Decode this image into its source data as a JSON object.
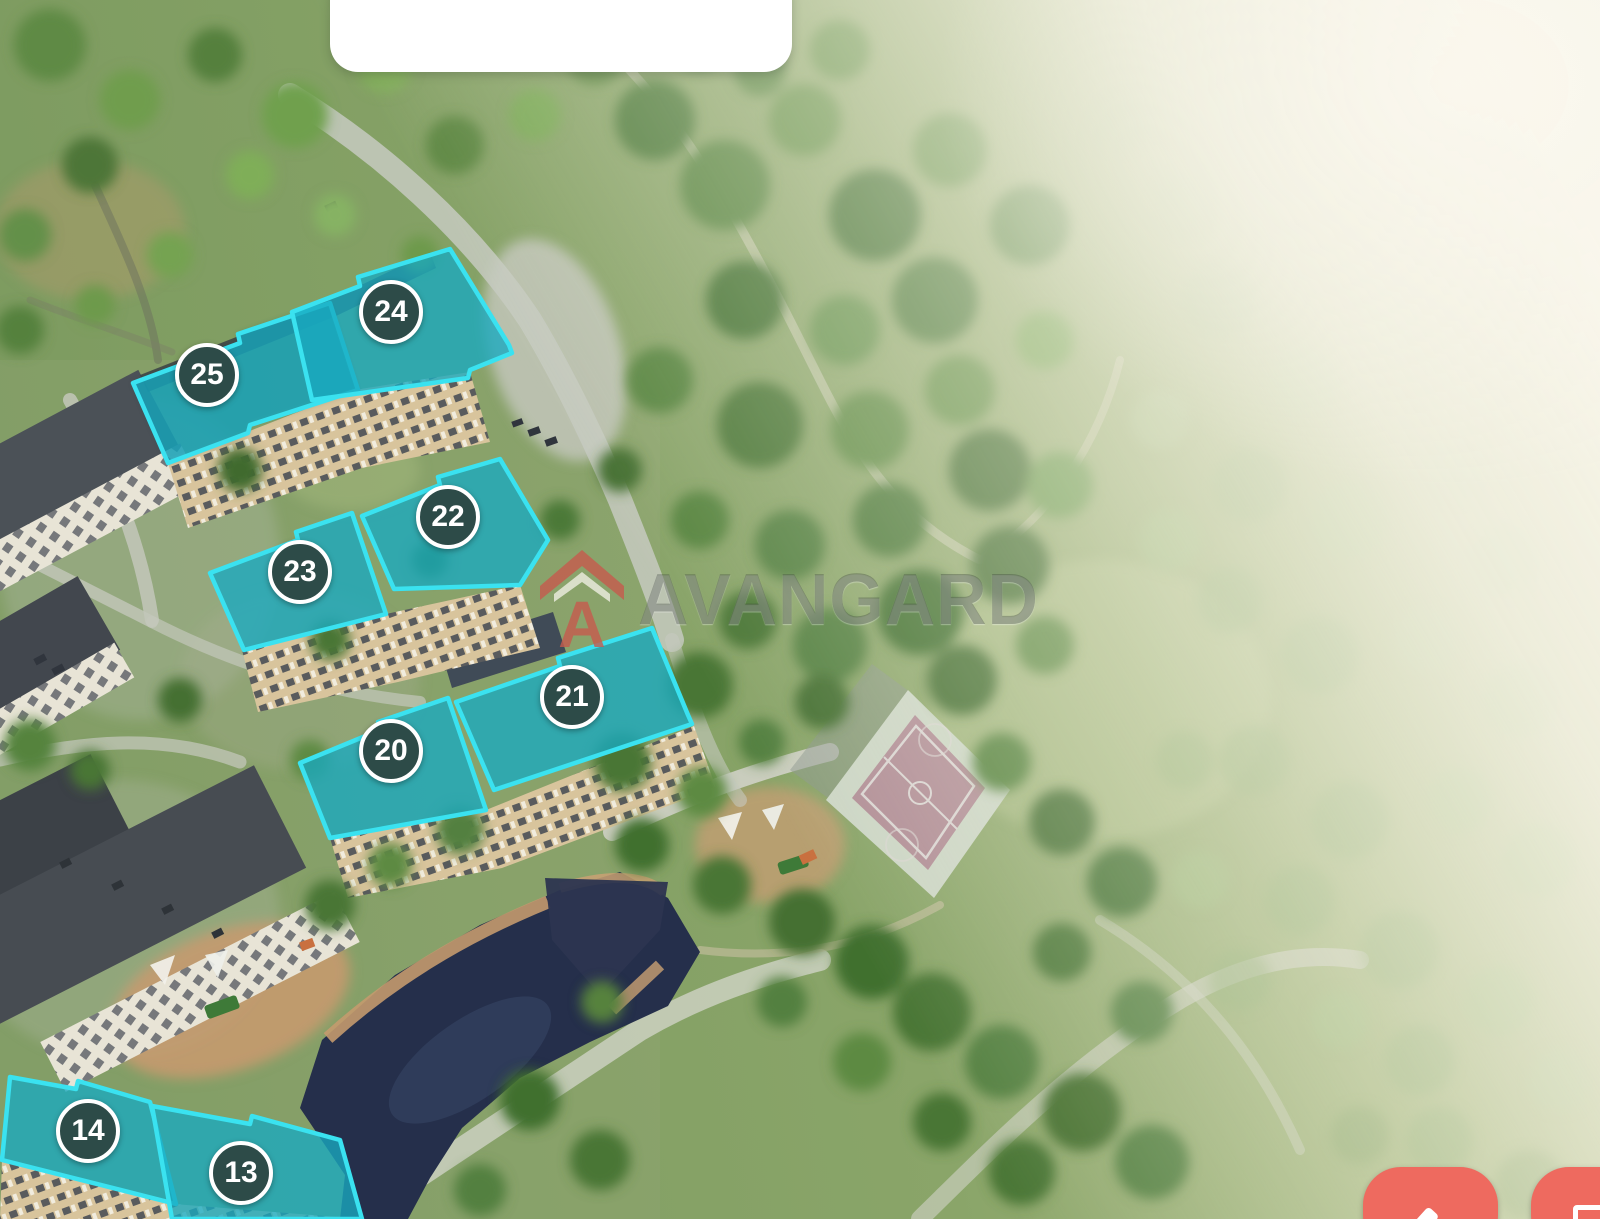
{
  "map": {
    "watermark": {
      "text": "AVANGARD",
      "logo_icon": "avangard-roof-a-logo"
    },
    "markers": [
      {
        "label": "24"
      },
      {
        "label": "25"
      },
      {
        "label": "22"
      },
      {
        "label": "23"
      },
      {
        "label": "21"
      },
      {
        "label": "20"
      },
      {
        "label": "14"
      },
      {
        "label": "13"
      }
    ],
    "popup": {
      "text": ""
    },
    "controls": [
      {
        "icon": "diagonal-arrow-icon"
      },
      {
        "icon": "building-outline-icon"
      }
    ],
    "colors": {
      "highlight_fill": "#18a9c0",
      "highlight_border": "#3ae2f0",
      "marker_background": "#2d4b48",
      "marker_text": "#ffffff",
      "control_button": "#ee6a5f",
      "watermark_logo": "#c65a4e",
      "court_surface": "#b18e96"
    }
  }
}
